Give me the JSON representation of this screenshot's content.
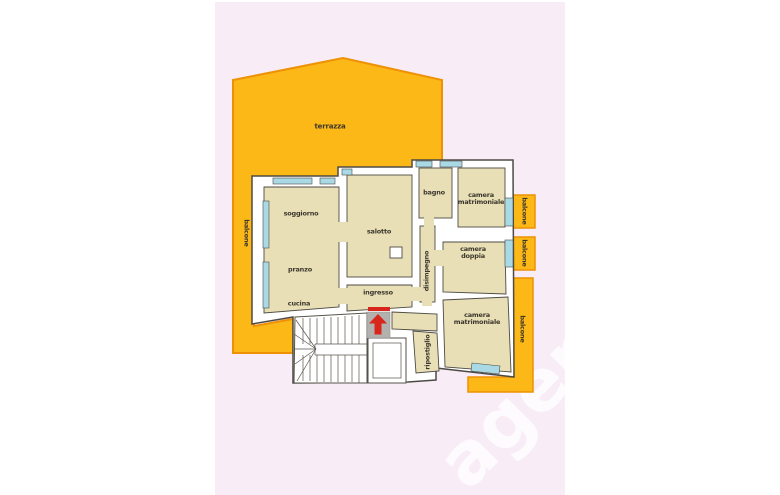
{
  "watermark": "agenzia",
  "colors": {
    "panel_pink": "#f8edf7",
    "terrace_fill": "#fcb816",
    "terrace_border": "#ee9105",
    "room_fill": "#e8dfb6",
    "wall_fill": "#ffffff",
    "wall_outline": "#4e4b45",
    "window_fill": "#a9d9e4",
    "landing_gray": "#b2b1ad",
    "arrow_red": "#d9261c",
    "label_color": "#3b362c"
  },
  "labels": {
    "terrazza": "terrazza",
    "balcone_left": "balcone",
    "soggiorno": "soggiorno",
    "salotto": "salotto",
    "bagno": "bagno",
    "camera_matrimoniale_top": {
      "line1": "camera",
      "line2": "matrimoniale"
    },
    "balcone_top": "balcone",
    "camera_doppia": {
      "line1": "camera",
      "line2": "doppia"
    },
    "balcone_mid": "balcone",
    "disimpegno": "disimpegno",
    "pranzo": "pranzo",
    "ingresso": "ingresso",
    "cucina": "cucina",
    "camera_matrimoniale_bottom": {
      "line1": "camera",
      "line2": "matrimoniale"
    },
    "balcone_bottom": "balcone",
    "ripostiglio": "ripostiglio"
  }
}
